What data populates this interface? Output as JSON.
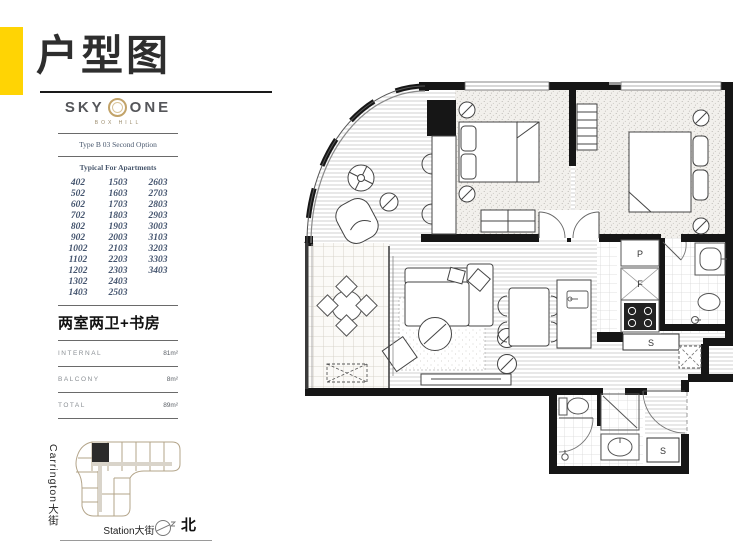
{
  "page": {
    "title": "户型图"
  },
  "brand": {
    "name_left": "SKY",
    "name_right": "ONE",
    "subtitle": "BOX HILL"
  },
  "plan_info": {
    "type_label": "Type B 03 Second Option",
    "list_title": "Typical For Apartments",
    "apartments": [
      [
        "402",
        "1503",
        "2603"
      ],
      [
        "502",
        "1603",
        "2703"
      ],
      [
        "602",
        "1703",
        "2803"
      ],
      [
        "702",
        "1803",
        "2903"
      ],
      [
        "802",
        "1903",
        "3003"
      ],
      [
        "902",
        "2003",
        "3103"
      ],
      [
        "1002",
        "2103",
        "3203"
      ],
      [
        "1102",
        "2203",
        "3303"
      ],
      [
        "1202",
        "2303",
        "3403"
      ],
      [
        "1302",
        "2403",
        ""
      ],
      [
        "1403",
        "2503",
        ""
      ]
    ],
    "layout_name": "两室两卫+书房",
    "areas": [
      {
        "label": "INTERNAL",
        "value": "81m²"
      },
      {
        "label": "BALCONY",
        "value": "8m²"
      },
      {
        "label": "TOTAL",
        "value": "89m²"
      }
    ]
  },
  "site_map": {
    "street_left": "Carrington大街",
    "street_bottom": "Station大街",
    "north_label": "北"
  },
  "floor_plan": {
    "labels": {
      "pantry": "P",
      "fridge": "F",
      "storage1": "S",
      "storage2": "S"
    }
  },
  "colors": {
    "accent_yellow": "#FFD404",
    "logo_gold": "#C2A369",
    "list_text": "#44546E",
    "plan_line": "#161616",
    "sitemap_tan": "#B3A489"
  }
}
